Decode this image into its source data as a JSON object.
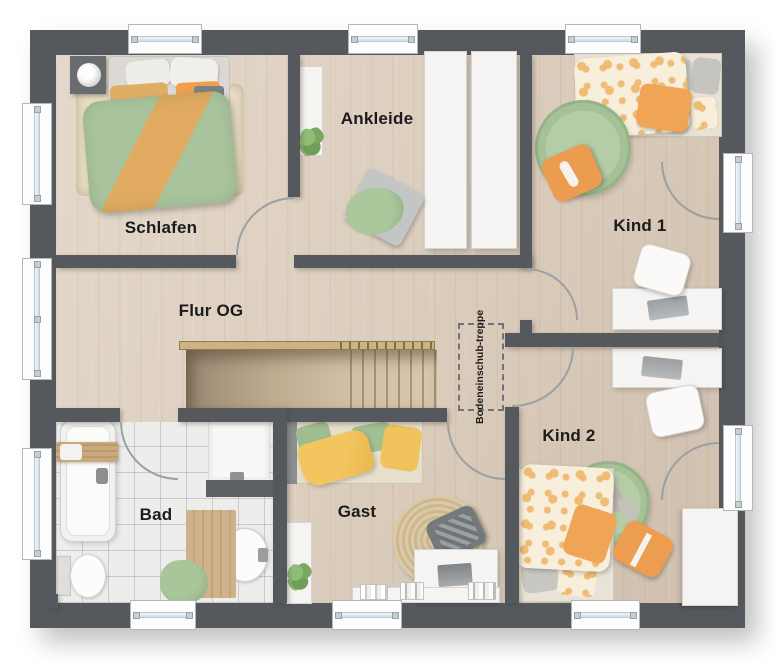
{
  "rooms": {
    "schlafen": {
      "label": "Schlafen"
    },
    "ankleide": {
      "label": "Ankleide"
    },
    "kind1": {
      "label": "Kind 1"
    },
    "flur": {
      "label": "Flur OG"
    },
    "bad": {
      "label": "Bad"
    },
    "gast": {
      "label": "Gast"
    },
    "kind2": {
      "label": "Kind 2"
    }
  },
  "annotations": {
    "attic_stairs_line1": "Bodeneinschub-",
    "attic_stairs_line2": "treppe"
  },
  "colors": {
    "wall": "#55595d",
    "wood_floor": "#ddcfbf",
    "tile_floor": "#ededeb",
    "accent_green": "#a9c39a",
    "accent_orange": "#eda65c",
    "white_furniture": "#f5f4f2",
    "window_glass": "#d6e4ea",
    "rail_wood": "#ccb384"
  }
}
